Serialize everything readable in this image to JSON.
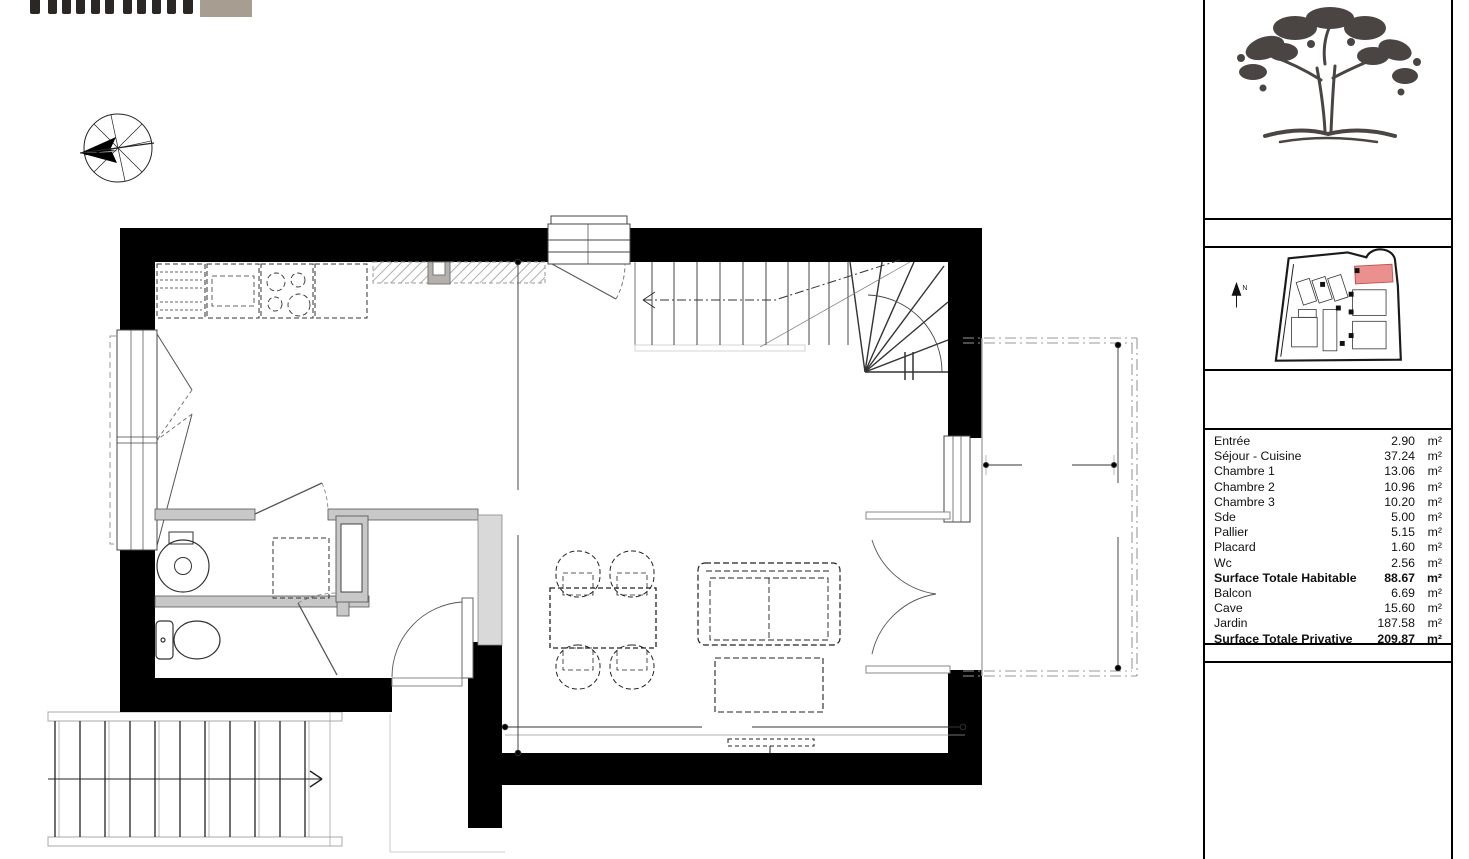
{
  "branding": {
    "partner": {
      "tagline": "immobilier",
      "square_color": "#a79d90"
    },
    "project": {
      "line1": "mas des",
      "line2": "CAROUBIERS",
      "ink": "#44403d"
    }
  },
  "compass": {
    "vent_espagne": "Vent d'espagne",
    "ouest": "OUEST",
    "tramontane": "Tramontane",
    "sud": "SUD",
    "nord": "NORD",
    "marin": "Marin",
    "est": "EST"
  },
  "plan": {
    "labels": {
      "sejour": "Séjour - Cuisine",
      "placard": "Placard",
      "entree": "Entrée",
      "wc": "Wc",
      "balcon": "Balcon",
      "lv": "LV",
      "r": "R",
      "ll": "LL",
      "etel": "ETEL"
    },
    "stair": {
      "note1": "16H x 175,0 mm",
      "note2": "15F x 254,2 mm",
      "numbers": [
        "16",
        "15",
        "14",
        "13",
        "12",
        "11",
        "10",
        "9",
        "8",
        "7",
        "6",
        "5",
        "4",
        "3",
        "2",
        "1"
      ]
    },
    "dims": {
      "sejour_h": "5,62",
      "sejour_w": "5,06",
      "balcon_w": "1,91",
      "balcon_h": "3,77"
    }
  },
  "panel": {
    "title": "PLAN DE PRE-COMMERCIALISATION",
    "unit": {
      "code": "M05",
      "type": "Type : T4",
      "level": "Niveau :  R+1"
    },
    "areas": {
      "rows": [
        {
          "label": "Entrée",
          "value": "2.90",
          "unit": "m²",
          "bold": false
        },
        {
          "label": "Séjour - Cuisine",
          "value": "37.24",
          "unit": "m²",
          "bold": false
        },
        {
          "label": "Chambre 1",
          "value": "13.06",
          "unit": "m²",
          "bold": false
        },
        {
          "label": "Chambre 2",
          "value": "10.96",
          "unit": "m²",
          "bold": false
        },
        {
          "label": "Chambre 3",
          "value": "10.20",
          "unit": "m²",
          "bold": false
        },
        {
          "label": "Sde",
          "value": "5.00",
          "unit": "m²",
          "bold": false
        },
        {
          "label": "Pallier",
          "value": "5.15",
          "unit": "m²",
          "bold": false
        },
        {
          "label": "Placard",
          "value": "1.60",
          "unit": "m²",
          "bold": false
        },
        {
          "label": "Wc",
          "value": "2.56",
          "unit": "m²",
          "bold": false
        },
        {
          "label": "Surface Totale Habitable",
          "value": "88.67",
          "unit": "m²",
          "bold": true
        },
        {
          "label": "Balcon",
          "value": "6.69",
          "unit": "m²",
          "bold": false
        },
        {
          "label": "Cave",
          "value": "15.60",
          "unit": "m²",
          "bold": false
        },
        {
          "label": "Jardin",
          "value": "187.58",
          "unit": "m²",
          "bold": false
        },
        {
          "label": "Surface Totale Privative",
          "value": "209.87",
          "unit": "m²",
          "bold": true
        }
      ]
    },
    "legend": {
      "title": "LEGENDE",
      "items": [
        {
          "key": "SDE",
          "label": "SALLE D'EAU"
        },
        {
          "key": "DGT",
          "label": "DEGAGEMENT"
        },
        {
          "key": "ETEL",
          "label": "TABLEAU ELECTRIQUE"
        },
        {
          "key": "R",
          "label": "REFRIGERATEUR"
        },
        {
          "key": "LV",
          "label": "LAVE VAISSELLE"
        },
        {
          "key": "LL",
          "label": "LAVE LINGE"
        },
        {
          "icon": "beam",
          "label": "RETOMBEE DE POUTRE"
        },
        {
          "icon": "soffit",
          "label": "SOFFITE ET FAUX PLAFOND"
        },
        {
          "icon": "demontable",
          "label": "DEMONTABLE"
        },
        {
          "icon": "cuisson",
          "label": "CUISSON"
        },
        {
          "key": "R",
          "label": "REFRIGERATEUR"
        },
        {
          "key": "LV",
          "label": "LAVE VAISSELLE"
        }
      ]
    },
    "colors": {
      "highlight_red": "#ec8f8f",
      "beam_cyan": "#8ad6d4"
    }
  }
}
